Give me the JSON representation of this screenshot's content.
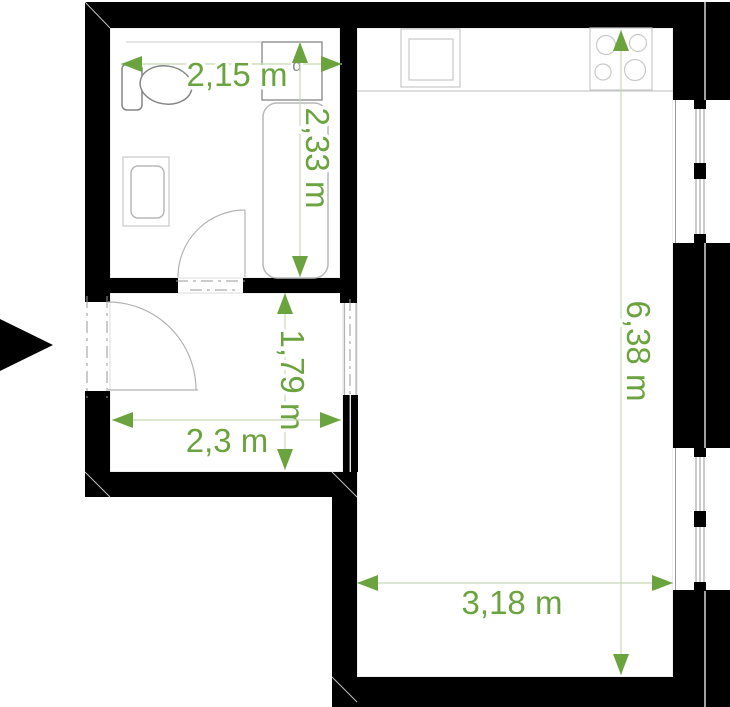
{
  "plan": {
    "unit": "m",
    "colors": {
      "wall": "#000000",
      "accent_green": "#6ba33f",
      "dimension_line": "#c7d8b6",
      "fixture_line": "#c9c9c9",
      "background": "#ffffff"
    },
    "dimensions": {
      "bathroom_width": {
        "label": "2,15 m",
        "superscript": "d"
      },
      "bathroom_depth": {
        "label": "2,33 m"
      },
      "hallway_depth": {
        "label": "1,79 m"
      },
      "hallway_width": {
        "label": "2,3 m"
      },
      "room_depth": {
        "label": "6,38 m"
      },
      "room_width": {
        "label": "3,18 m"
      }
    }
  }
}
